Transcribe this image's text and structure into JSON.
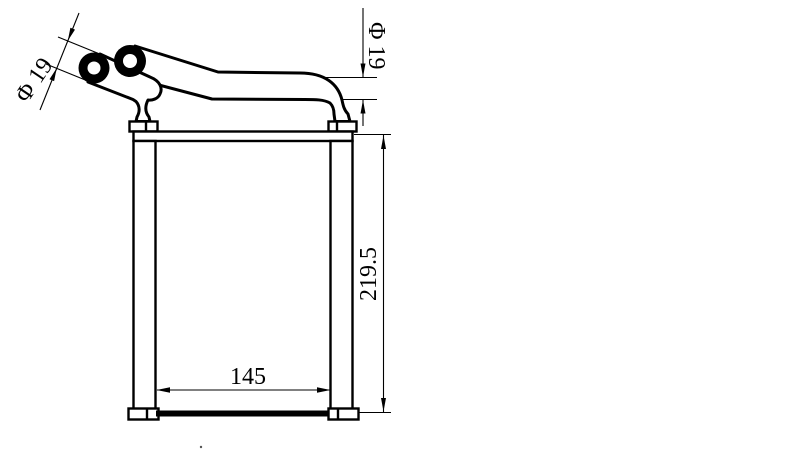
{
  "drawing": {
    "description": "heater-core-technical-drawing",
    "background_color": "#ffffff",
    "line_color": "#000000",
    "labels": {
      "pipe_diameter_left": "Φ 19",
      "pipe_diameter_right": "Φ 19",
      "core_height": "219.5",
      "core_width": "145"
    }
  }
}
